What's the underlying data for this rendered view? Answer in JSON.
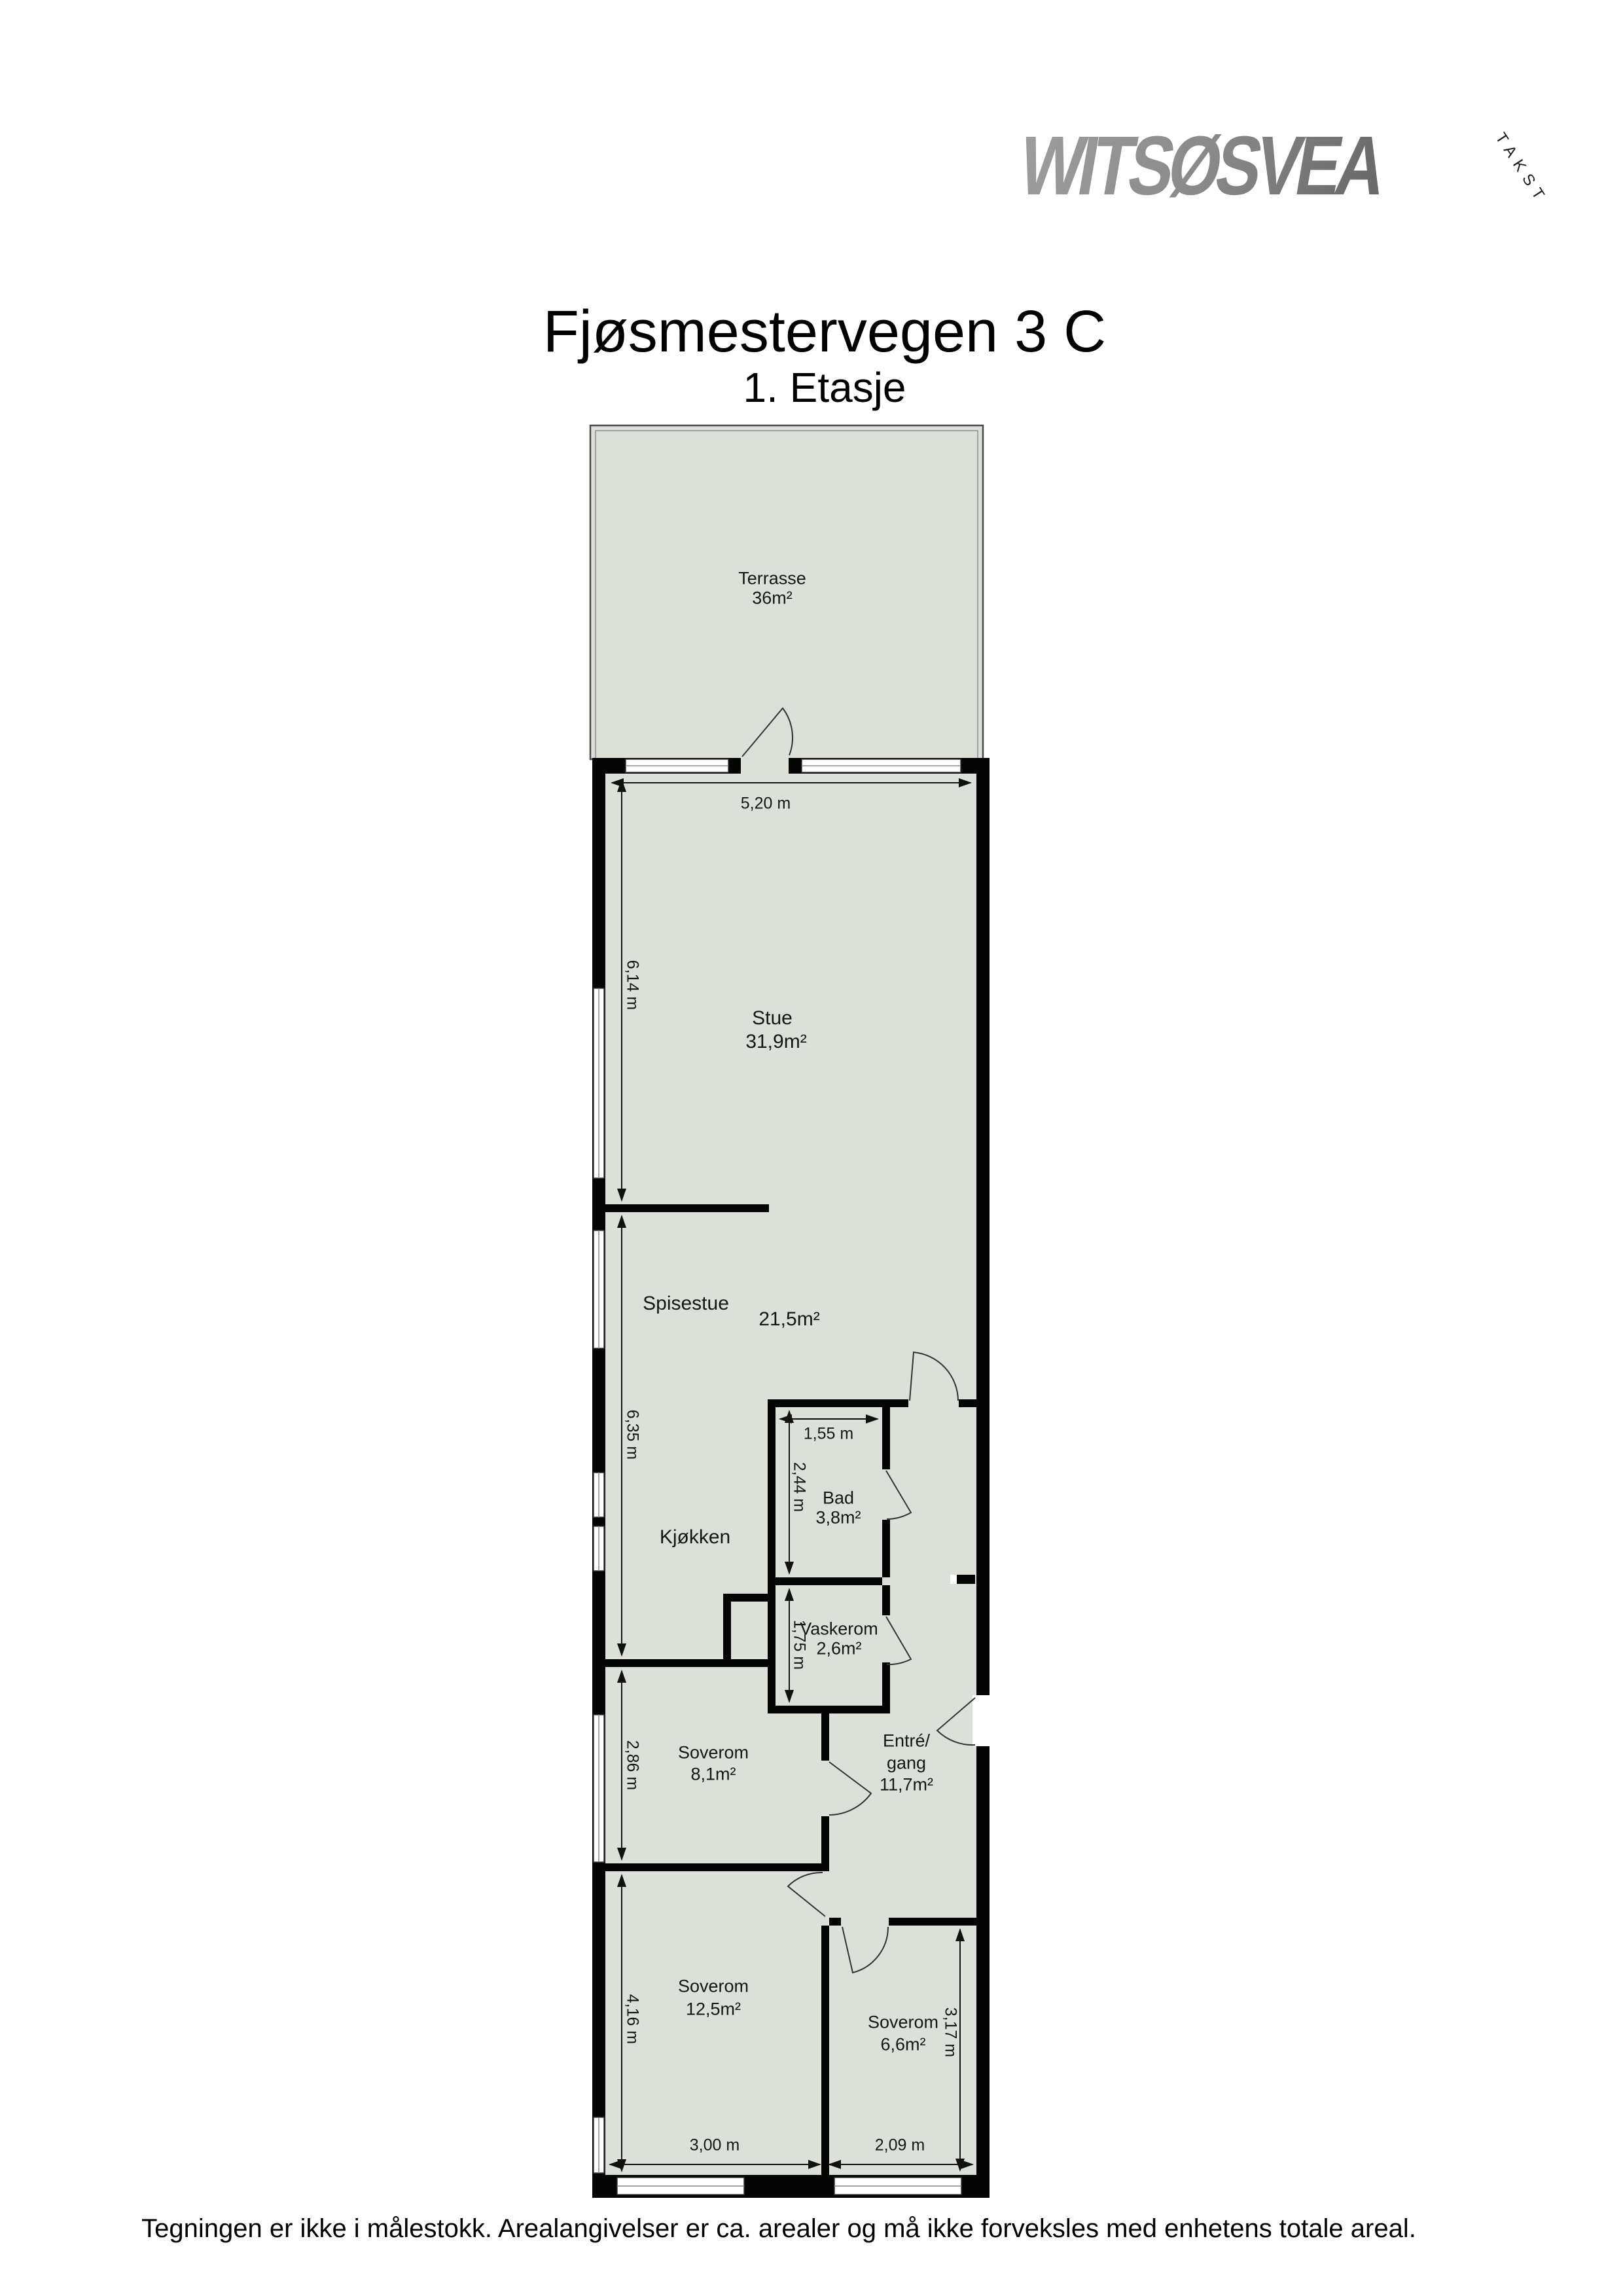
{
  "logo": {
    "brand": "WITSØSVEA",
    "tagline": "TAKST"
  },
  "title": "Fjøsmestervegen 3 C",
  "subtitle": "1. Etasje",
  "footer": "Tegningen er ikke i målestokk. Arealangivelser er ca. arealer og må ikke forveksles med enhetens totale areal.",
  "rooms": {
    "terrasse": {
      "name": "Terrasse",
      "area": "36m²"
    },
    "stue": {
      "name": "Stue",
      "area": "31,9m²"
    },
    "spisestue": {
      "name": "Spisestue",
      "area": "21,5m²"
    },
    "kjokken": {
      "name": "Kjøkken"
    },
    "bad": {
      "name": "Bad",
      "area": "3,8m²"
    },
    "vaskerom": {
      "name": "Vaskerom",
      "area": "2,6m²"
    },
    "soverom1": {
      "name": "Soverom",
      "area": "8,1m²"
    },
    "entre": {
      "name": "Entré/",
      "name2": "gang",
      "area": "11,7m²"
    },
    "soverom2": {
      "name": "Soverom",
      "area": "12,5m²"
    },
    "soverom3": {
      "name": "Soverom",
      "area": "6,6m²"
    }
  },
  "dimensions": {
    "w_top": "5,20 m",
    "h_stue": "6,14 m",
    "h_spis": "6,35 m",
    "h_sov1": "2,86 m",
    "h_sov2": "4,16 m",
    "w_bad": "1,55 m",
    "h_bad": "2,44 m",
    "h_vask": "1,75 m",
    "w_sov2": "3,00 m",
    "w_sov3": "2,09 m",
    "h_sov3": "3,17 m"
  },
  "colors": {
    "floor": "#dbe0d8",
    "wall": "#050505",
    "logo_gray": "#868686"
  }
}
